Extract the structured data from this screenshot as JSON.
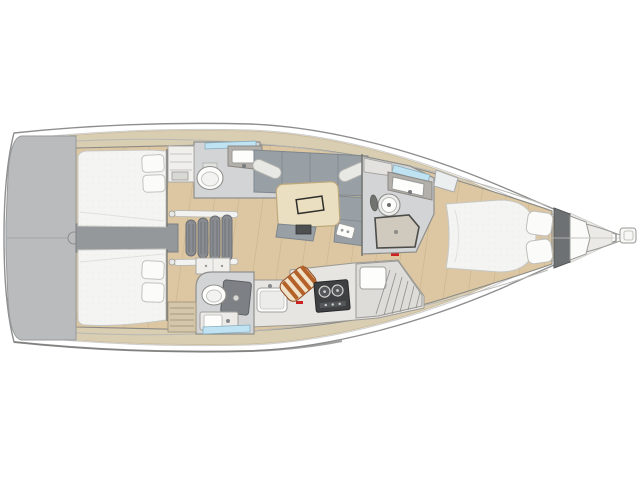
{
  "meta": {
    "type": "yacht-interior-floor-plan",
    "view": "top-down",
    "orientation": "bow-right-stern-left"
  },
  "colors": {
    "background": "#ffffff",
    "hull_fill": "#ffffff",
    "hull_outline": "#8e8e8e",
    "hull_shadow_edge": "#7a7a78",
    "sheer_line": "#cccccc",
    "deck": "#d9cdb2",
    "coachroof_line": "#b8b8b4",
    "transom": "#b9bbbd",
    "wood_floor": "#dcc7a2",
    "wood_plank_line": "#c9b28c",
    "bed": "#f4f4f2",
    "bed_dot": "#e6e6e3",
    "pillow": "#fbfbfa",
    "sofa": "#98a0a6",
    "sofa_edge": "#7f878d",
    "bolster": "#e8e8e5",
    "table": "#eadfc0",
    "table_edge": "#bfa87c",
    "tray_outline": "#2f2f2d",
    "head_floor": "#d3d4d6",
    "head_wall": "#8f8f8c",
    "counter": "#b3b0ab",
    "fixture_white": "#fdfdfc",
    "cabinet_white": "#f0efec",
    "door_panel": "#dbd9d5",
    "engine_box": "#95989b",
    "stair_rung": "#898d91",
    "stair_rail": "#f2f2f0",
    "stove": "#3e4042",
    "stove_panel": "#55585a",
    "cutting_board_stripe": "#b4622a",
    "cutting_board_base": "#f0e2c8",
    "window_glass": "#bfe3f2",
    "accent_red": "#cc2222",
    "bow_bulkhead": "#6e7173",
    "anchor_locker": "#fbfbfa",
    "bow_deck": "#eceae6",
    "shower_pan": "#cfc9be",
    "shower_column": "#7d8084",
    "galley_base": "#e7e5e1",
    "galley_unit": "#dddcd8",
    "bench_wood": "#d4c6a9",
    "dark_fitting": "#4d4f51",
    "towel_dark": "#71736f"
  },
  "plan": {
    "vessel": "sailing-yacht-monohull",
    "areas": [
      {
        "id": "swim-platform",
        "label": "transom-swim-platform"
      },
      {
        "id": "port-aft-cabin",
        "label": "aft-double-berth-cabin"
      },
      {
        "id": "starboard-aft-cabin",
        "label": "aft-double-berth-cabin"
      },
      {
        "id": "engine-compartment",
        "label": "engine-box-between-cabins"
      },
      {
        "id": "companionway-stairs",
        "label": "companionway-steps"
      },
      {
        "id": "port-aft-head",
        "label": "head-toilet-sink-shower-glass"
      },
      {
        "id": "starboard-aft-head",
        "label": "head-toilet-shower-sink"
      },
      {
        "id": "salon",
        "label": "salon-sofa-and-table"
      },
      {
        "id": "galley",
        "label": "galley-sink-stove-worktop"
      },
      {
        "id": "forward-head",
        "label": "head-toilet-sink-shower-pan"
      },
      {
        "id": "forward-cabin",
        "label": "forward-island-berth"
      },
      {
        "id": "anchor-locker",
        "label": "anchor-locker"
      },
      {
        "id": "bowsprit",
        "label": "bowsprit"
      }
    ]
  }
}
